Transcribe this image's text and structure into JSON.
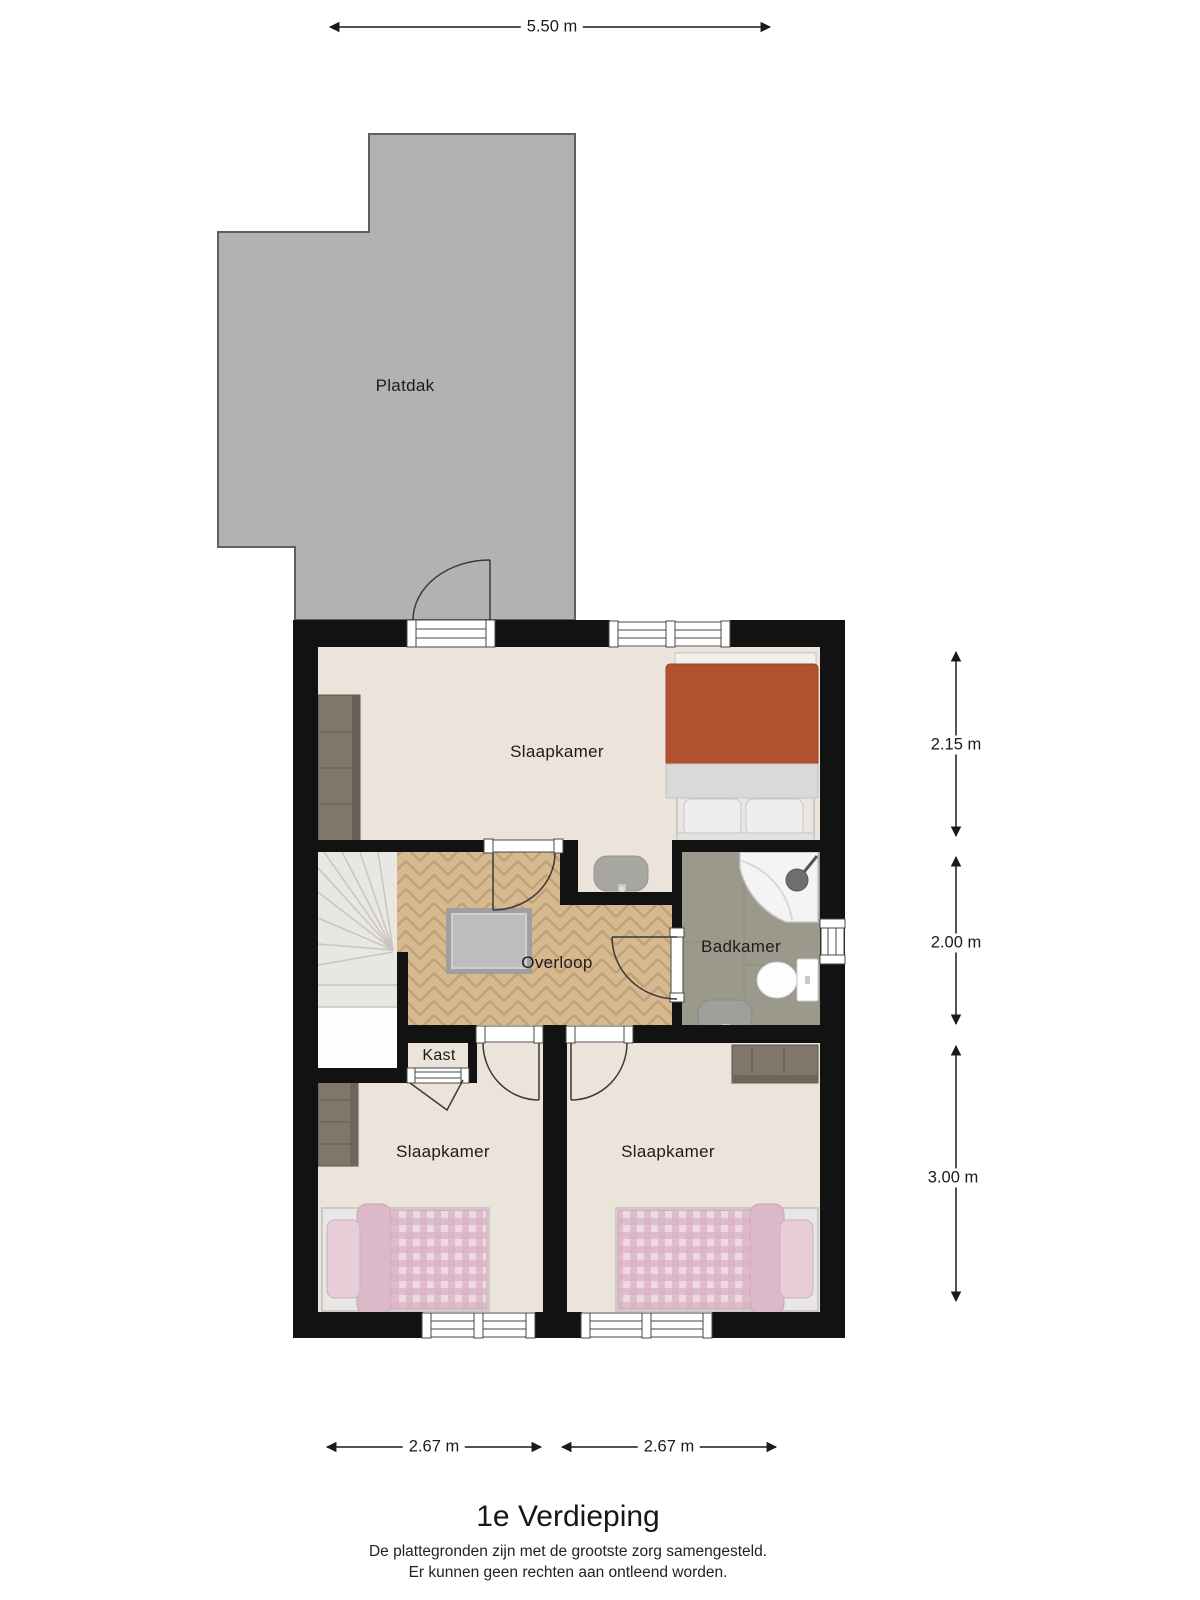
{
  "labels": {
    "platdak": "Platdak",
    "slaapkamer_top": "Slaapkamer",
    "overloop": "Overloop",
    "badkamer": "Badkamer",
    "kast": "Kast",
    "slaapkamer_left": "Slaapkamer",
    "slaapkamer_right": "Slaapkamer"
  },
  "dimensions": {
    "width_top": "5.50 m",
    "right_top": "2.15 m",
    "right_middle": "2.00 m",
    "right_bottom": "3.00 m",
    "bottom_left": "2.67 m",
    "bottom_right": "2.67 m"
  },
  "title": "1e Verdieping",
  "disclaimer_line1": "De plattegronden zijn met de grootste zorg samengesteld.",
  "disclaimer_line2": "Er kunnen geen rechten aan ontleend worden.",
  "colors": {
    "wall": "#121212",
    "roof_fill": "#b2b2b2",
    "roof_border": "#5f5f5f",
    "bedroom_floor": "#ece4da",
    "overloop_floor": "#d7b990",
    "badkamer_floor": "#9b998c",
    "kast_floor": "#9e9e9c",
    "stairs": "#e9e7e3",
    "bed_double": "#b1512f",
    "bed_single": "#d9b3c4",
    "furniture_wood": "#80776a"
  }
}
